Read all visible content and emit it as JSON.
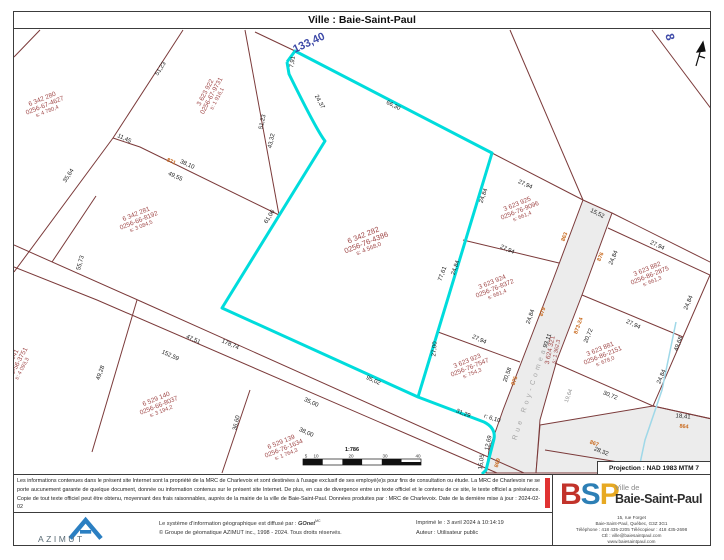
{
  "title": "Ville : Baie-Saint-Paul",
  "projection": "Projection : NAD 1983 MTM 7",
  "colors": {
    "highlight": "#00dcdc",
    "lot_line": "#7b3a3a",
    "parcel_text": "#a04848",
    "civic": "#c96a1e",
    "blue_dim": "#3f4ba8",
    "road_fill": "#ececec",
    "stream": "#9fd8e8",
    "red_bar": "#e03232"
  },
  "map": {
    "blue_labels": [
      {
        "t": "133,40",
        "x": 309,
        "y": 43,
        "r": -25,
        "size": 11
      },
      {
        "t": "8",
        "x": 670,
        "y": 37,
        "r": 75,
        "size": 12
      }
    ],
    "parcels": [
      {
        "lot": "6 342 280",
        "mat": "0256-67-4627",
        "surf": "s: 4 780,4",
        "x": 45,
        "y": 106,
        "r": -22,
        "big": false
      },
      {
        "lot": "3 623 922",
        "mat": "0256-67-9731",
        "surf": "s: 1 916,1",
        "x": 212,
        "y": 96,
        "r": -62,
        "big": false
      },
      {
        "lot": "6 342 281",
        "mat": "0256-66-8192",
        "surf": "s: 3 084,5",
        "x": 139,
        "y": 221,
        "r": -22,
        "big": false
      },
      {
        "lot": "6 342 282",
        "mat": "0256-76-4386",
        "surf": "s: 4 568,0",
        "x": 366,
        "y": 242,
        "r": -22,
        "big": true
      },
      {
        "lot": "3 623 925",
        "mat": "0256-76-9096",
        "surf": "s: 661,4",
        "x": 520,
        "y": 211,
        "r": -22,
        "big": false
      },
      {
        "lot": "3 623 924",
        "mat": "0256-76-8372",
        "surf": "s: 681,4",
        "x": 495,
        "y": 289,
        "r": -22,
        "big": false
      },
      {
        "lot": "3 623 923",
        "mat": "0256-76-7547",
        "surf": "s: 754,3",
        "x": 470,
        "y": 368,
        "r": -22,
        "big": false
      },
      {
        "lot": "3 623 882",
        "mat": "0256-86-2875",
        "surf": "s: 661,3",
        "x": 650,
        "y": 276,
        "r": -22,
        "big": false
      },
      {
        "lot": "3 623 881",
        "mat": "0256-86-2151",
        "surf": "s: 678,0",
        "x": 603,
        "y": 356,
        "r": -22,
        "big": false
      },
      {
        "lot": "6 529 140",
        "mat": "0256-66-8037",
        "surf": "s: 3 194,2",
        "x": 159,
        "y": 406,
        "r": -22,
        "big": false
      },
      {
        "lot": "6 529 139",
        "mat": "0256-76-1634",
        "surf": "s: 1 764,3",
        "x": 284,
        "y": 449,
        "r": -22,
        "big": false
      },
      {
        "lot": "6 529 141",
        "mat": "0256-56-3751",
        "surf": "s: 4 093,3",
        "x": 17,
        "y": 366,
        "r": -62,
        "big": false
      }
    ],
    "road": {
      "name": "Rue Roy-Comeau",
      "name_x": 531,
      "name_y": 390,
      "name_r": -72,
      "lot": "3 624 321",
      "surface": "s: 1 362,3",
      "lot_x": 554,
      "lot_y": 351,
      "lot_r": -78
    },
    "dim_labels": [
      {
        "t": "51,23",
        "x": 161,
        "y": 69,
        "r": -57
      },
      {
        "t": "11,45",
        "x": 124,
        "y": 139,
        "r": 25
      },
      {
        "t": "38,10",
        "x": 187,
        "y": 165,
        "r": 25
      },
      {
        "t": "49,55",
        "x": 175,
        "y": 177,
        "r": 25
      },
      {
        "t": "35,64",
        "x": 69,
        "y": 176,
        "r": -57
      },
      {
        "t": "55,73",
        "x": 81,
        "y": 263,
        "r": -75
      },
      {
        "t": "51,23",
        "x": 263,
        "y": 122,
        "r": -78
      },
      {
        "t": "43,32",
        "x": 272,
        "y": 141,
        "r": -78
      },
      {
        "t": "7,91",
        "x": 293,
        "y": 62,
        "r": -80
      },
      {
        "t": "24,37",
        "x": 319,
        "y": 102,
        "r": 62
      },
      {
        "t": "66,30",
        "x": 393,
        "y": 106,
        "r": 27
      },
      {
        "t": "61,06",
        "x": 270,
        "y": 217,
        "r": -58
      },
      {
        "t": "24,84",
        "x": 484,
        "y": 196,
        "r": -70
      },
      {
        "t": "77,61",
        "x": 443,
        "y": 274,
        "r": -70
      },
      {
        "t": "24,84",
        "x": 456,
        "y": 268,
        "r": -70
      },
      {
        "t": "27,00",
        "x": 435,
        "y": 349,
        "r": -85
      },
      {
        "t": "27,94",
        "x": 525,
        "y": 185,
        "r": 24
      },
      {
        "t": "27,94",
        "x": 507,
        "y": 250,
        "r": 24
      },
      {
        "t": "27,94",
        "x": 479,
        "y": 340,
        "r": 24
      },
      {
        "t": "24,84",
        "x": 531,
        "y": 317,
        "r": -70
      },
      {
        "t": "20,58",
        "x": 508,
        "y": 375,
        "r": -70
      },
      {
        "t": "15,52",
        "x": 597,
        "y": 214,
        "r": 26
      },
      {
        "t": "27,94",
        "x": 657,
        "y": 246,
        "r": 25
      },
      {
        "t": "24,84",
        "x": 614,
        "y": 258,
        "r": -67
      },
      {
        "t": "24,84",
        "x": 689,
        "y": 303,
        "r": -67
      },
      {
        "t": "27,94",
        "x": 633,
        "y": 325,
        "r": 25
      },
      {
        "t": "24,84",
        "x": 662,
        "y": 377,
        "r": -67
      },
      {
        "t": "49,68",
        "x": 679,
        "y": 344,
        "r": -70
      },
      {
        "t": "30,72",
        "x": 610,
        "y": 396,
        "r": 22
      },
      {
        "t": "18,41",
        "x": 683,
        "y": 417,
        "r": 5
      },
      {
        "t": "95,02",
        "x": 373,
        "y": 381,
        "r": 25
      },
      {
        "t": "35,00",
        "x": 311,
        "y": 403,
        "r": 25
      },
      {
        "t": "38,00",
        "x": 306,
        "y": 433,
        "r": 25
      },
      {
        "t": "47,51",
        "x": 193,
        "y": 340,
        "r": 24
      },
      {
        "t": "178,74",
        "x": 230,
        "y": 345,
        "r": 24
      },
      {
        "t": "152,59",
        "x": 170,
        "y": 356,
        "r": 24
      },
      {
        "t": "49,28",
        "x": 101,
        "y": 373,
        "r": -70
      },
      {
        "t": "36,60",
        "x": 237,
        "y": 423,
        "r": -77
      },
      {
        "t": "31,29",
        "x": 463,
        "y": 414,
        "r": 21
      },
      {
        "t": "r: 6,10",
        "x": 492,
        "y": 419,
        "r": 18
      },
      {
        "t": "12,69",
        "x": 489,
        "y": 443,
        "r": -78
      },
      {
        "t": "15,05",
        "x": 482,
        "y": 462,
        "r": -82
      },
      {
        "t": "93,11",
        "x": 548,
        "y": 341,
        "r": -70
      },
      {
        "t": "20,72",
        "x": 589,
        "y": 336,
        "r": -67
      },
      {
        "t": "28,32",
        "x": 601,
        "y": 452,
        "r": 22
      }
    ],
    "grey_dim_labels": [
      {
        "t": "19,64",
        "x": 569,
        "y": 396,
        "r": -70
      }
    ],
    "civic_labels": [
      {
        "t": "871",
        "x": 171,
        "y": 162,
        "r": 25
      },
      {
        "t": "863",
        "x": 565,
        "y": 237,
        "r": -70
      },
      {
        "t": "876",
        "x": 601,
        "y": 257,
        "r": -67
      },
      {
        "t": "879",
        "x": 543,
        "y": 312,
        "r": -70
      },
      {
        "t": "875",
        "x": 515,
        "y": 381,
        "r": -70
      },
      {
        "t": "873-24",
        "x": 579,
        "y": 326,
        "r": -70
      },
      {
        "t": "869",
        "x": 498,
        "y": 463,
        "r": -75
      },
      {
        "t": "867",
        "x": 594,
        "y": 444,
        "r": 20
      },
      {
        "t": "864",
        "x": 684,
        "y": 427,
        "r": 5
      }
    ],
    "scalebar": {
      "ratio": "1:786",
      "ticks": [
        {
          "t": "5",
          "x": 306
        },
        {
          "t": "10",
          "x": 316
        },
        {
          "t": "20",
          "x": 351
        },
        {
          "t": "30",
          "x": 385
        },
        {
          "t": "40",
          "x": 418
        }
      ]
    }
  },
  "disclaimer": "Les informations contenues dans le présent site Internet sont la propriété de la MRC de Charlevoix et sont destinées à l'usage exclusif de ses employé(e)s pour fins de consultation ou étude. La MRC de Charlevoix ne se porte aucunement garante de quelque document, donnée ou information contenus sur le présent site Internet. De plus, en cas de divergence entre un texte officiel et le contenu de ce site, le texte officiel a préséance. Copie de tout texte officiel peut être obtenu, moyennant des frais raisonnables, auprès de la mairie de la ville de Baie-Saint-Paul. Données produites par : MRC de Charlevoix. Date de la dernière mise à jour : 2024-02-02",
  "credits": {
    "azimut_word": "AZIMUT",
    "line1_prefix": "Le système d'information géographique est diffusé par : ",
    "brand": "GOnet",
    "brand_sup": "MC",
    "line2": "© Groupe de géomatique AZIMUT inc., 1998 - 2024. Tous droits réservés."
  },
  "print_info": {
    "printed": "Imprimé le : 3 avril 2024 à 10:14:19",
    "author": "Auteur : Utilisateur public"
  },
  "bsp": {
    "b": "B",
    "s": "S",
    "p": "P",
    "ville_de": "Ville de",
    "name": "Baie-Saint-Paul",
    "address1": "15, rue Forget",
    "address2": "Baie-Saint-Paul, Québec, G3Z 3G1",
    "address3": "Téléphone : 418 435-2205 Télécopieur : 418 435-2698",
    "address4": "CÉ : ville@baiesaintpaul.com",
    "address5": "www.baiesaintpaul.com"
  }
}
